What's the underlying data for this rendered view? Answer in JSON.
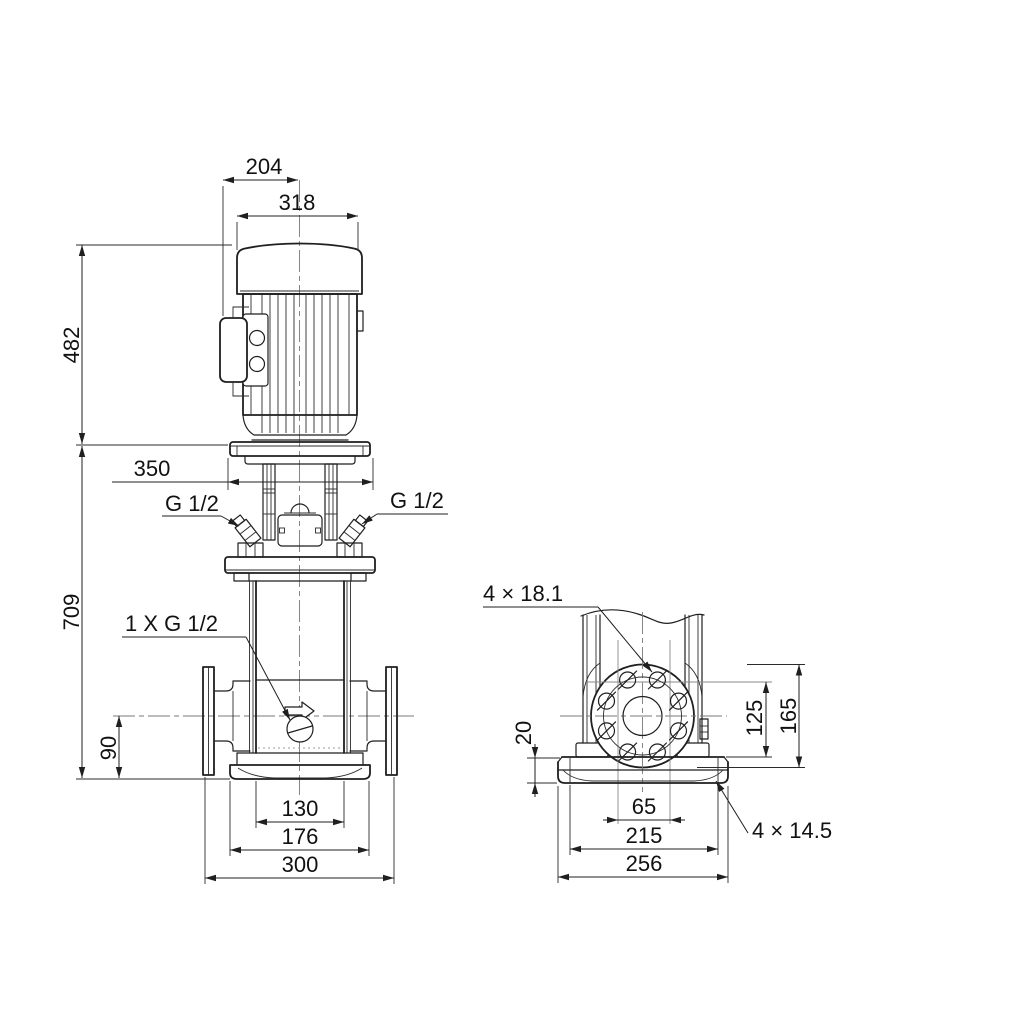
{
  "drawing": {
    "title": "pump-dimensional-drawing",
    "background": "#ffffff",
    "line_color": "#1f1f1f",
    "labels": {
      "dim_204": "204",
      "dim_318": "318",
      "dim_482": "482",
      "dim_350": "350",
      "port_top_left": "G 1/2",
      "port_top_right": "G 1/2",
      "dim_709": "709",
      "drain_port": "1 X G 1/2",
      "dim_90": "90",
      "dim_130": "130",
      "dim_176": "176",
      "dim_300": "300",
      "flange_holes": "4 × 18.1",
      "dim_20": "20",
      "dim_125": "125",
      "dim_165": "165",
      "dim_65": "65",
      "dim_215": "215",
      "dim_256": "256",
      "base_plate_holes": "4 × 14.5"
    }
  }
}
